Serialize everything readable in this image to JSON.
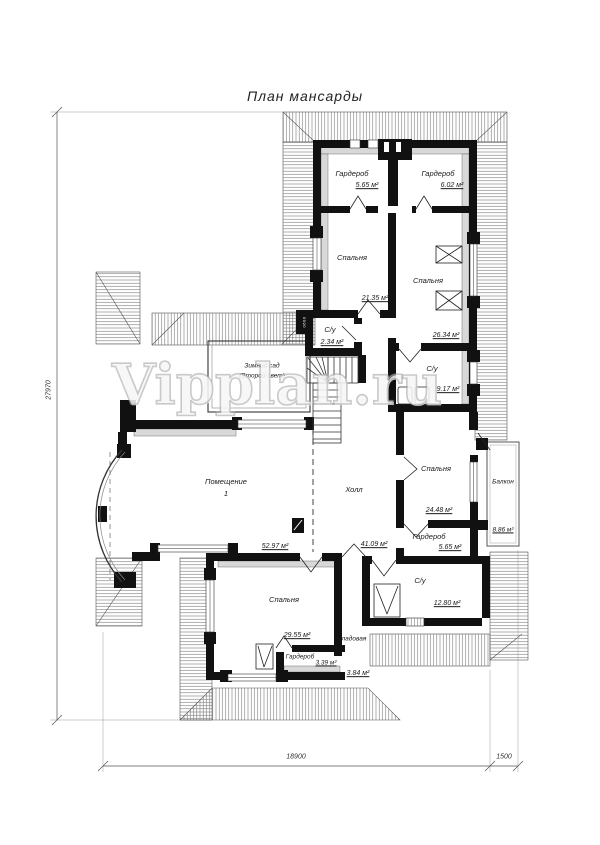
{
  "title": "План мансарды",
  "watermark": "Vipplan.ru",
  "door_marker": "0600",
  "rooms": [
    {
      "name": "Гардероб",
      "area": "5.65 м²"
    },
    {
      "name": "Гардероб",
      "area": "6.02 м²"
    },
    {
      "name": "Спальня",
      "area": "21.35 м²"
    },
    {
      "name": "Спальня",
      "area": "26.34 м²"
    },
    {
      "name": "С/у",
      "area": "2.34 м²"
    },
    {
      "name": "С/у",
      "area": "9.17 м²"
    },
    {
      "name": "Зимний сад",
      "note": "(Второй свет)"
    },
    {
      "name": "Помещение",
      "number": "1",
      "area": "52.97 м²"
    },
    {
      "name": "Холл",
      "area": "41.09 м²"
    },
    {
      "name": "Спальня",
      "area": "24.48 м²"
    },
    {
      "name": "Гардероб",
      "area": "5.65 м²"
    },
    {
      "name": "Балкон",
      "area": "8.86 м²"
    },
    {
      "name": "С/у",
      "area": "12.80 м²"
    },
    {
      "name": "Кладовая",
      "area": "3.84 м²"
    },
    {
      "name": "Спальня",
      "area": "29.55 м²"
    },
    {
      "name": "Гардероб",
      "area": "3.39 м²"
    }
  ],
  "dimensions": {
    "height_total": "27970",
    "width_main": "18900",
    "width_balcony": "1500"
  }
}
